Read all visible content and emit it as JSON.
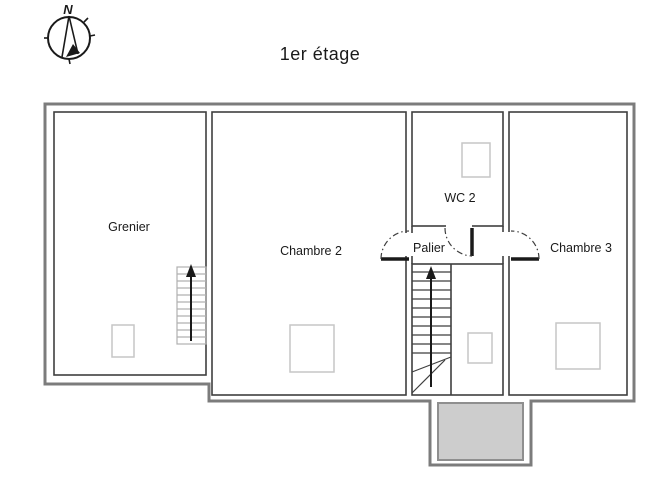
{
  "title": "1er étage",
  "compass": {
    "label": "N"
  },
  "rooms": [
    {
      "id": "grenier",
      "label": "Grenier"
    },
    {
      "id": "chambre2",
      "label": "Chambre 2"
    },
    {
      "id": "wc2",
      "label": "WC 2"
    },
    {
      "id": "palier",
      "label": "Palier"
    },
    {
      "id": "chambre3",
      "label": "Chambre 3"
    }
  ],
  "colors": {
    "ink": "#1a1a1a",
    "wall": "#7c7c7c",
    "room_line": "#3f3f3f",
    "fixture_line": "#c6c6c6",
    "stair_light": "#b0b0b0",
    "porch_fill": "#cdcdcd",
    "porch_line": "#8f8f8f"
  }
}
